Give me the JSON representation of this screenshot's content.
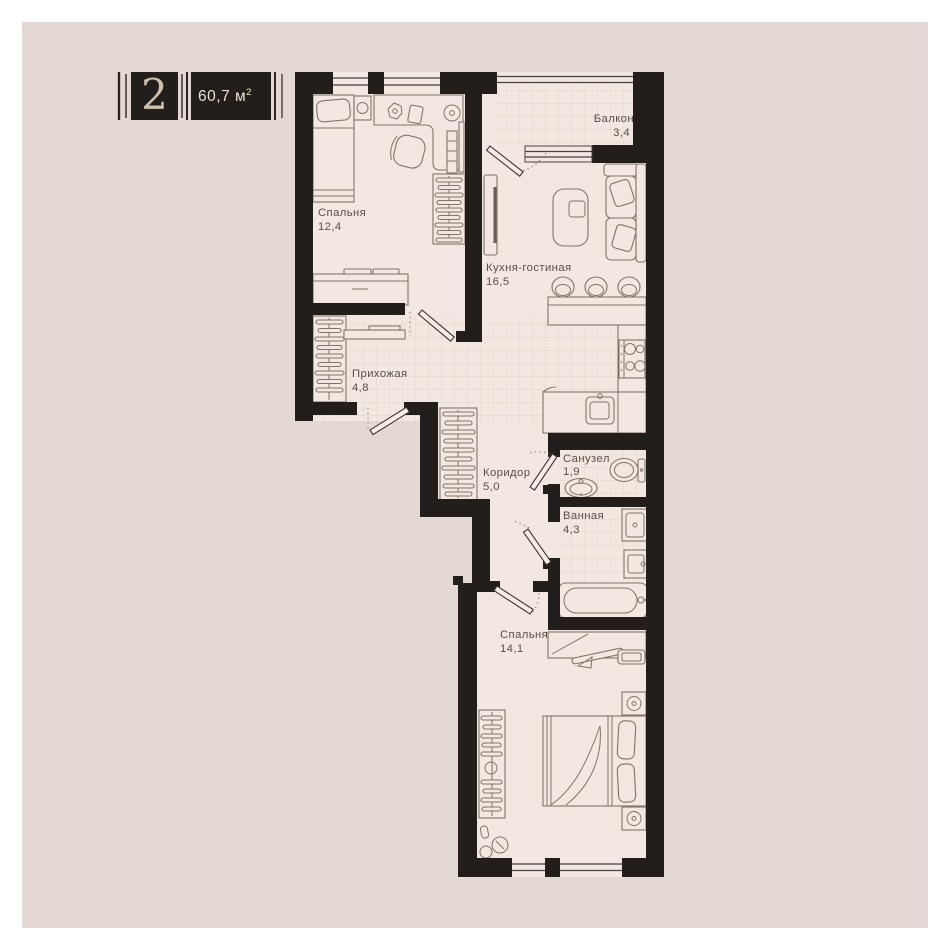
{
  "badge": {
    "number": "2",
    "area_value": "60,7 м",
    "area_sup": "2"
  },
  "rooms": [
    {
      "id": "bedroom-1",
      "name": "Спальня",
      "area": "12,4"
    },
    {
      "id": "balcony",
      "name": "Балкон",
      "area": "3,4"
    },
    {
      "id": "kitchen-living",
      "name": "Кухня-гостиная",
      "area": "16,5"
    },
    {
      "id": "hallway",
      "name": "Прихожая",
      "area": "4,8"
    },
    {
      "id": "corridor",
      "name": "Коридор",
      "area": "5,0"
    },
    {
      "id": "wc",
      "name": "Санузел",
      "area": "1,9"
    },
    {
      "id": "bathroom",
      "name": "Ванная",
      "area": "4,3"
    },
    {
      "id": "bedroom-2",
      "name": "Спальня",
      "area": "14,1"
    }
  ],
  "colors": {
    "page_background": "#e4d9d2",
    "page_border": "#ffffff",
    "wall": "#221e1b",
    "floor": "#f2e8e1",
    "badge_box": "#221e1b",
    "badge_number": "#cfc0ae",
    "badge_area_text": "#ece1d4",
    "label_text": "#57504a"
  }
}
